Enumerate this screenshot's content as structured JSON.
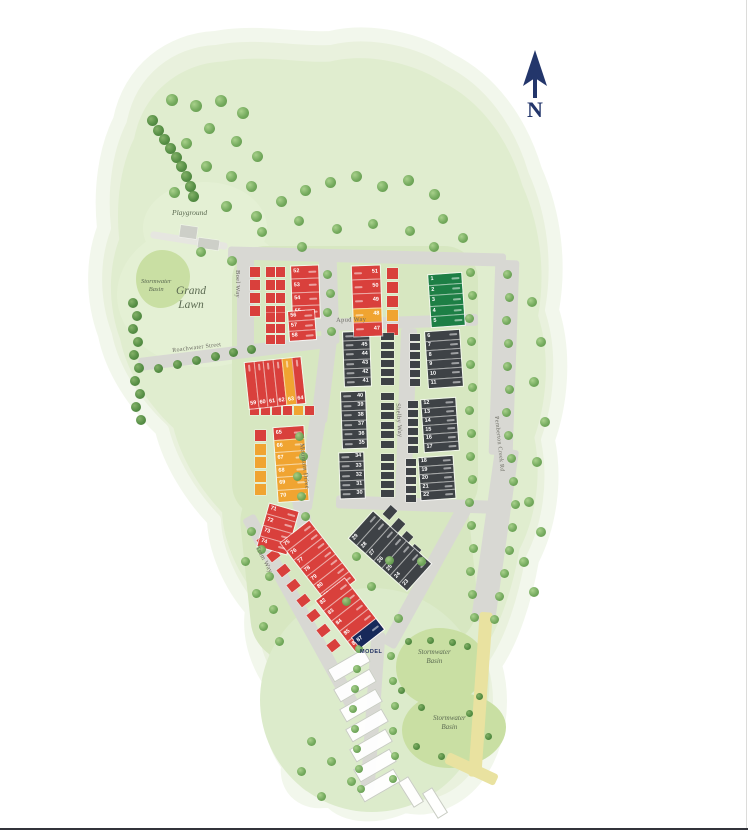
{
  "compass": {
    "label": "N"
  },
  "colors": {
    "red": "#d9403c",
    "yellow": "#f0a431",
    "dark": "#3e4246",
    "green": "#1d7f45",
    "navy": "#17295a",
    "gray": "#cdcfc8",
    "road": "#d8d8d3",
    "site": "#e9f1dd",
    "basin": "#c9dfa3",
    "tree_light": "#6fa758",
    "tree_dark": "#4f8a3e"
  },
  "map": {
    "roads": [
      {
        "name": "north-road",
        "x": 228,
        "y": 250,
        "w": 278,
        "h": 13,
        "rot": 1.5
      },
      {
        "name": "boel-way",
        "label": "Boel Way",
        "x": 237,
        "y": 253,
        "w": 17,
        "h": 96,
        "rot": 0,
        "lx": 241,
        "ly": 270,
        "lrot": 90,
        "lsize": 6.5
      },
      {
        "name": "spine-road",
        "x": 320,
        "y": 252,
        "w": 18,
        "h": 92,
        "rot": -2
      },
      {
        "name": "mountain-drive-a",
        "x": 316,
        "y": 338,
        "w": 16,
        "h": 85,
        "rot": 7
      },
      {
        "name": "mountain-drive-b",
        "label": "Mountain Drive",
        "x": 303,
        "y": 415,
        "w": 16,
        "h": 95,
        "rot": 9,
        "lx": 305,
        "ly": 443,
        "lrot": 83,
        "lsize": 6.5
      },
      {
        "name": "mountain-drive-c",
        "x": 298,
        "y": 498,
        "w": 15,
        "h": 62,
        "rot": -12
      },
      {
        "name": "roachwater-street",
        "label": "Roachwater Street",
        "x": 138,
        "y": 346,
        "w": 198,
        "h": 13,
        "rot": -7,
        "lx": 172,
        "ly": 348,
        "lrot": -7,
        "lsize": 6
      },
      {
        "name": "apud-way",
        "label": "Apud Way",
        "x": 288,
        "y": 317,
        "w": 190,
        "h": 12,
        "rot": -2,
        "lx": 336,
        "ly": 317,
        "lrot": -2,
        "lsize": 6.5
      },
      {
        "name": "shelby-way",
        "label": "Shelby Way",
        "x": 398,
        "y": 328,
        "w": 16,
        "h": 178,
        "rot": 2,
        "lx": 401,
        "ly": 403,
        "lrot": 86,
        "lsize": 6.5
      },
      {
        "name": "south-road",
        "x": 336,
        "y": 498,
        "w": 156,
        "h": 13,
        "rot": 2
      },
      {
        "name": "basin-road",
        "x": 419,
        "y": 498,
        "w": 15,
        "h": 158,
        "rot": 29
      },
      {
        "name": "bottom-road",
        "x": 366,
        "y": 632,
        "w": 14,
        "h": 158,
        "rot": 4
      },
      {
        "name": "tram-way",
        "label": "Tram Way",
        "x": 294,
        "y": 503,
        "w": 14,
        "h": 218,
        "rot": -29,
        "lx": 260,
        "ly": 545,
        "lrot": 62,
        "lsize": 6.5
      },
      {
        "name": "pemberton-creek-rd-a",
        "x": 492,
        "y": 260,
        "w": 24,
        "h": 195,
        "rot": 2
      },
      {
        "name": "pemberton-creek-rd-b",
        "label": "Pemberton Creek Rd",
        "x": 483,
        "y": 448,
        "w": 24,
        "h": 175,
        "rot": 8,
        "lx": 499,
        "ly": 416,
        "lrot": 84,
        "lsize": 6
      },
      {
        "name": "playground-path",
        "x": 150,
        "y": 237,
        "w": 78,
        "h": 7,
        "rot": 9,
        "cls": "light"
      },
      {
        "name": "basin-path-a",
        "x": 474,
        "y": 612,
        "w": 13,
        "h": 165,
        "rot": 4,
        "cls": "sand"
      },
      {
        "name": "basin-path-b",
        "x": 444,
        "y": 763,
        "w": 55,
        "h": 12,
        "rot": 25,
        "cls": "sand"
      }
    ],
    "basins": [
      {
        "name": "stormwater-basin-west",
        "x": 136,
        "y": 250,
        "w": 54,
        "h": 58
      },
      {
        "name": "stormwater-basin-north",
        "x": 396,
        "y": 628,
        "w": 90,
        "h": 78
      },
      {
        "name": "stormwater-basin-south",
        "x": 402,
        "y": 692,
        "w": 104,
        "h": 76
      }
    ],
    "blocks": [
      {
        "name": "lots-1-5",
        "x": 430,
        "y": 274,
        "w": 33,
        "h": 52,
        "rot": -4,
        "numSide": "l",
        "lots": [
          [
            1,
            "g"
          ],
          [
            2,
            "g"
          ],
          [
            3,
            "g"
          ],
          [
            4,
            "g"
          ],
          [
            5,
            "g"
          ]
        ]
      },
      {
        "name": "lots-6-11",
        "x": 427,
        "y": 331,
        "w": 34,
        "h": 56,
        "rot": -4,
        "numSide": "l",
        "lots": [
          [
            6,
            "d"
          ],
          [
            7,
            "d"
          ],
          [
            8,
            "d"
          ],
          [
            9,
            "d"
          ],
          [
            10,
            "d"
          ],
          [
            11,
            "d"
          ]
        ]
      },
      {
        "name": "lots-12-17",
        "x": 423,
        "y": 399,
        "w": 34,
        "h": 52,
        "rot": -4,
        "numSide": "l",
        "lots": [
          [
            12,
            "d"
          ],
          [
            13,
            "d"
          ],
          [
            14,
            "d"
          ],
          [
            15,
            "d"
          ],
          [
            16,
            "d"
          ],
          [
            17,
            "d"
          ]
        ]
      },
      {
        "name": "lots-18-22",
        "x": 420,
        "y": 457,
        "w": 34,
        "h": 42,
        "rot": -4,
        "numSide": "l",
        "lots": [
          [
            18,
            "d"
          ],
          [
            19,
            "d"
          ],
          [
            20,
            "d"
          ],
          [
            21,
            "d"
          ],
          [
            22,
            "d"
          ]
        ]
      },
      {
        "name": "lots-23-29",
        "x": 372,
        "y": 512,
        "w": 36,
        "h": 78,
        "rot": -48,
        "numSide": "l",
        "lots": [
          [
            29,
            "d"
          ],
          [
            28,
            "d"
          ],
          [
            27,
            "d"
          ],
          [
            26,
            "d"
          ],
          [
            25,
            "d"
          ],
          [
            24,
            "d"
          ],
          [
            23,
            "d"
          ]
        ]
      },
      {
        "name": "lots-41-46",
        "x": 344,
        "y": 332,
        "w": 26,
        "h": 54,
        "rot": -2,
        "numSide": "r",
        "lots": [
          [
            46,
            "d"
          ],
          [
            45,
            "d"
          ],
          [
            44,
            "d"
          ],
          [
            43,
            "d"
          ],
          [
            42,
            "d"
          ],
          [
            41,
            "d"
          ]
        ]
      },
      {
        "name": "lots-35-40",
        "x": 342,
        "y": 392,
        "w": 24,
        "h": 56,
        "rot": -2,
        "numSide": "r",
        "lots": [
          [
            40,
            "d"
          ],
          [
            39,
            "d"
          ],
          [
            38,
            "d"
          ],
          [
            37,
            "d"
          ],
          [
            36,
            "d"
          ],
          [
            35,
            "d"
          ]
        ]
      },
      {
        "name": "lots-30-34",
        "x": 340,
        "y": 453,
        "w": 24,
        "h": 45,
        "rot": -2,
        "numSide": "r",
        "lots": [
          [
            34,
            "d"
          ],
          [
            33,
            "d"
          ],
          [
            32,
            "d"
          ],
          [
            31,
            "d"
          ],
          [
            30,
            "d"
          ]
        ]
      },
      {
        "name": "lots-52-55",
        "x": 292,
        "y": 266,
        "w": 27,
        "h": 52,
        "rot": -2,
        "numSide": "l",
        "lots": [
          [
            52,
            "r"
          ],
          [
            53,
            "r"
          ],
          [
            54,
            "r"
          ],
          [
            55,
            "r"
          ]
        ]
      },
      {
        "name": "lots-56-58",
        "x": 289,
        "y": 311,
        "w": 26,
        "h": 29,
        "rot": -4,
        "numSide": "l",
        "lots": [
          [
            56,
            "r"
          ],
          [
            57,
            "r"
          ],
          [
            58,
            "r"
          ]
        ]
      },
      {
        "name": "lots-47-51",
        "x": 353,
        "y": 266,
        "w": 28,
        "h": 70,
        "rot": -2,
        "numSide": "r",
        "lots": [
          [
            51,
            "r"
          ],
          [
            50,
            "r"
          ],
          [
            49,
            "r"
          ],
          [
            48,
            "y"
          ],
          [
            47,
            "r"
          ]
        ]
      },
      {
        "name": "lots-59-64",
        "x": 247,
        "y": 360,
        "w": 56,
        "h": 46,
        "rot": -6,
        "dir": "row",
        "numSide": "b",
        "lots": [
          [
            59,
            "r"
          ],
          [
            60,
            "r"
          ],
          [
            61,
            "r"
          ],
          [
            62,
            "r"
          ],
          [
            63,
            "y"
          ],
          [
            64,
            "r"
          ]
        ]
      },
      {
        "name": "lots-65-70",
        "x": 276,
        "y": 427,
        "w": 30,
        "h": 74,
        "rot": -4,
        "numSide": "l",
        "lots": [
          [
            65,
            "r"
          ],
          [
            66,
            "y"
          ],
          [
            67,
            "y"
          ],
          [
            68,
            "y"
          ],
          [
            69,
            "y"
          ],
          [
            70,
            "y"
          ]
        ]
      },
      {
        "name": "lots-71-74",
        "x": 263,
        "y": 507,
        "w": 30,
        "h": 44,
        "rot": 16,
        "numSide": "l",
        "lots": [
          [
            71,
            "r"
          ],
          [
            72,
            "r"
          ],
          [
            73,
            "r"
          ],
          [
            74,
            "r"
          ]
        ]
      },
      {
        "name": "lots-75-81",
        "x": 300,
        "y": 524,
        "w": 36,
        "h": 75,
        "rot": -38,
        "numSide": "l",
        "lots": [
          [
            75,
            "r"
          ],
          [
            76,
            "r"
          ],
          [
            77,
            "r"
          ],
          [
            78,
            "r"
          ],
          [
            79,
            "r"
          ],
          [
            80,
            "r"
          ],
          [
            81,
            "r"
          ]
        ]
      },
      {
        "name": "lots-82-86",
        "x": 332,
        "y": 583,
        "w": 36,
        "h": 64,
        "rot": -38,
        "numSide": "l",
        "lots": [
          [
            82,
            "r"
          ],
          [
            83,
            "r"
          ],
          [
            84,
            "r"
          ],
          [
            85,
            "r"
          ],
          [
            86,
            "r"
          ]
        ]
      },
      {
        "name": "lot-87-model",
        "x": 353,
        "y": 627,
        "w": 30,
        "h": 13,
        "rot": -38,
        "numSide": "l",
        "lots": [
          [
            87,
            "n"
          ]
        ]
      }
    ],
    "squares": [
      {
        "x": 250,
        "y": 267,
        "w": 10,
        "h": 10,
        "dy": 13,
        "n": 4,
        "c": "r"
      },
      {
        "x": 266,
        "y": 267,
        "w": 9,
        "h": 10,
        "dy": 13,
        "n": 4,
        "c": "r"
      },
      {
        "x": 276,
        "y": 267,
        "w": 9,
        "h": 10,
        "dy": 13,
        "n": 4,
        "c": "r"
      },
      {
        "x": 266,
        "y": 313,
        "w": 9,
        "h": 9,
        "dy": 11,
        "n": 3,
        "c": "r"
      },
      {
        "x": 276,
        "y": 313,
        "w": 9,
        "h": 9,
        "dy": 11,
        "n": 3,
        "c": "r"
      },
      {
        "x": 387,
        "y": 268,
        "w": 11,
        "h": 11,
        "dy": 14,
        "n": 5,
        "colors": [
          "r",
          "r",
          "r",
          "y",
          "r"
        ]
      },
      {
        "x": 381,
        "y": 333,
        "w": 13,
        "h": 7,
        "dy": 9,
        "n": 6,
        "c": "d"
      },
      {
        "x": 381,
        "y": 393,
        "w": 13,
        "h": 7,
        "dy": 9.5,
        "n": 6,
        "c": "d"
      },
      {
        "x": 381,
        "y": 454,
        "w": 13,
        "h": 7,
        "dy": 9,
        "n": 5,
        "c": "d"
      },
      {
        "x": 410,
        "y": 334,
        "w": 10,
        "h": 7,
        "dy": 9,
        "n": 6,
        "c": "d"
      },
      {
        "x": 408,
        "y": 401,
        "w": 10,
        "h": 7,
        "dy": 9,
        "n": 6,
        "c": "d"
      },
      {
        "x": 406,
        "y": 459,
        "w": 10,
        "h": 7,
        "dy": 9,
        "n": 5,
        "c": "d"
      },
      {
        "x": 384,
        "y": 508,
        "w": 12,
        "h": 9,
        "dx": 8,
        "dy": 13,
        "n": 5,
        "rot": -48,
        "c": "d"
      },
      {
        "x": 250,
        "y": 406,
        "w": 9,
        "h": 9,
        "dx": 11,
        "n": 6,
        "colors": [
          "r",
          "r",
          "r",
          "r",
          "y",
          "r"
        ]
      },
      {
        "x": 255,
        "y": 430,
        "w": 11,
        "h": 11,
        "dy": 13.5,
        "n": 5,
        "colors": [
          "r",
          "y",
          "y",
          "y",
          "y"
        ]
      },
      {
        "x": 258,
        "y": 536,
        "w": 11,
        "h": 9,
        "dx": 10,
        "dy": 15,
        "n": 8,
        "rot": -38,
        "c": "r"
      },
      {
        "x": 180,
        "y": 226,
        "w": 17,
        "h": 12,
        "rot": 8,
        "n": 1,
        "c": "x"
      },
      {
        "x": 198,
        "y": 239,
        "w": 21,
        "h": 10,
        "rot": 8,
        "n": 1,
        "c": "x"
      }
    ],
    "ghosts": [
      {
        "x": 328,
        "y": 658
      },
      {
        "x": 334,
        "y": 678
      },
      {
        "x": 340,
        "y": 698
      },
      {
        "x": 346,
        "y": 718
      },
      {
        "x": 350,
        "y": 738
      },
      {
        "x": 354,
        "y": 758
      },
      {
        "x": 358,
        "y": 778
      },
      {
        "x": 396,
        "y": 786,
        "w": 30,
        "h": 12,
        "rot": 58
      },
      {
        "x": 420,
        "y": 797,
        "w": 30,
        "h": 12,
        "rot": 58
      }
    ],
    "places": [
      {
        "name": "playground",
        "text": "Playground",
        "x": 172,
        "y": 208,
        "size": 7.5
      },
      {
        "name": "stormwater-basin-west-label",
        "text": "Stormwater\nBasin",
        "x": 141,
        "y": 278,
        "size": 6.5
      },
      {
        "name": "grand-lawn",
        "text": "Grand\nLawn",
        "x": 176,
        "y": 284,
        "size": 11.5
      },
      {
        "name": "stormwater-basin-north-label",
        "text": "Stormwater\nBasin",
        "x": 418,
        "y": 648,
        "size": 7
      },
      {
        "name": "stormwater-basin-south-label",
        "text": "Stormwater\nBasin",
        "x": 433,
        "y": 714,
        "size": 7
      },
      {
        "name": "model-home",
        "text": "MODEL",
        "x": 360,
        "y": 649,
        "size": 5.5,
        "cls": "model"
      }
    ]
  }
}
